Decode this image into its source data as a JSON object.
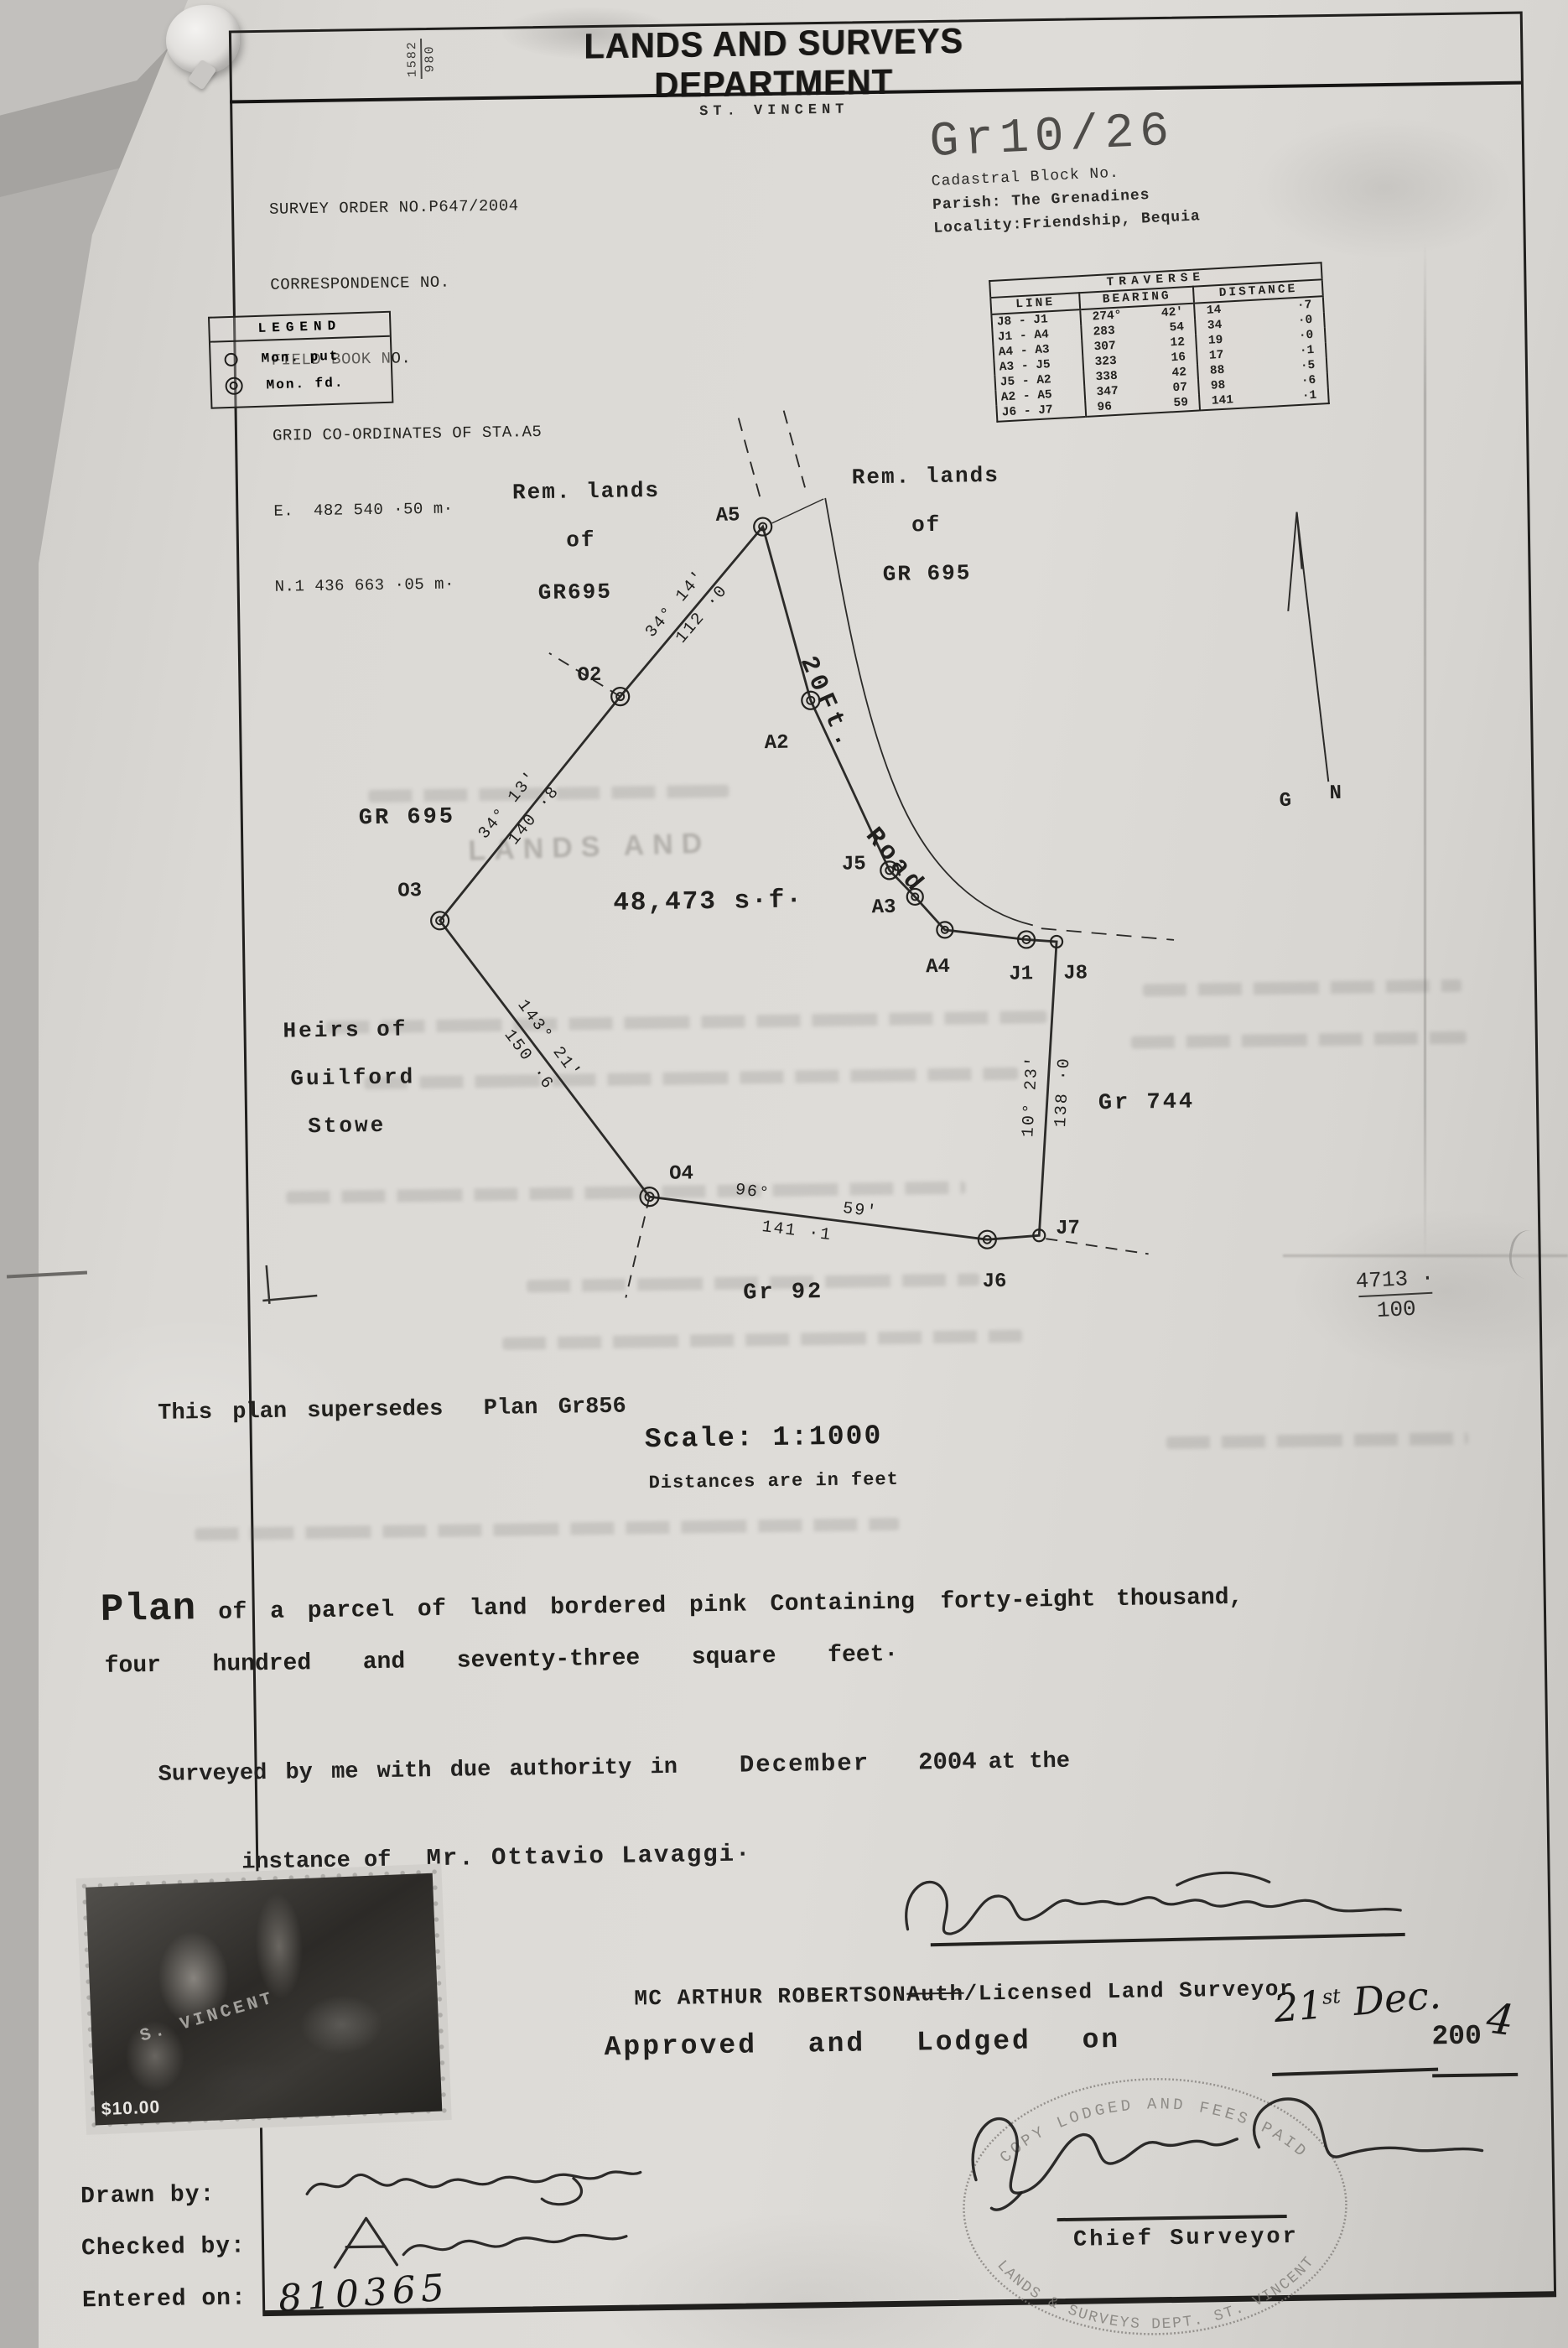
{
  "header": {
    "ref_top": "1582",
    "ref_bottom": "980",
    "title": "LANDS AND SURVEYS DEPARTMENT",
    "subtitle": "ST. VINCENT"
  },
  "survey_info": {
    "lines": [
      "SURVEY ORDER NO.P647/2004",
      "CORRESPONDENCE NO.",
      "FIELD BOOK NO.",
      "GRID CO-ORDINATES OF STA.A5",
      "E.  482 540 ·50 m·",
      "N.1 436 663 ·05 m·"
    ]
  },
  "block_ref": {
    "number": "Gr10/26",
    "label": "Cadastral Block No.",
    "parish": "Parish: The Grenadines",
    "locality": "Locality:Friendship, Bequia"
  },
  "traverse": {
    "title": "TRAVERSE",
    "col_line": "LINE",
    "col_bearing": "BEARING",
    "col_distance": "DISTANCE",
    "rows": [
      {
        "line": "J8 - J1",
        "deg": "274°",
        "min": "42'",
        "dw": "14",
        "dd": "·7"
      },
      {
        "line": "J1  - A4",
        "deg": "283",
        "min": "54",
        "dw": "34",
        "dd": "·0"
      },
      {
        "line": "A4  - A3",
        "deg": "307",
        "min": "12",
        "dw": "19",
        "dd": "·0"
      },
      {
        "line": "A3  - J5",
        "deg": "323",
        "min": "16",
        "dw": "17",
        "dd": "·1"
      },
      {
        "line": "J5  - A2",
        "deg": "338",
        "min": "42",
        "dw": "88",
        "dd": "·5"
      },
      {
        "line": "A2  - A5",
        "deg": "347",
        "min": "07",
        "dw": "98",
        "dd": "·6"
      },
      {
        "line": "J6 - J7",
        "deg": "96",
        "min": "59",
        "dw": "141",
        "dd": "·1"
      }
    ]
  },
  "legend": {
    "title": "LEGEND",
    "put_label": "Mon. put",
    "found_label": "Mon. fd."
  },
  "plot": {
    "points": {
      "a5": "A5",
      "o2": "O2",
      "a2": "A2",
      "o3": "O3",
      "j5": "J5",
      "a3": "A3",
      "a4": "A4",
      "j1": "J1",
      "j8": "J8",
      "o4": "O4",
      "j6": "J6",
      "j7": "J7"
    },
    "area": "48,473 s·f·",
    "gr695_left": "GR 695",
    "gr744": "Gr 744",
    "gr92": "Gr 92",
    "rem_left": [
      "Rem. lands",
      "of",
      "GR695"
    ],
    "rem_right": [
      "Rem. lands",
      "of",
      "GR 695"
    ],
    "heirs": [
      "Heirs of",
      "Guilford",
      "Stowe"
    ],
    "road": [
      "20Ft.",
      "Road"
    ],
    "b1": {
      "ang": "34° 14'",
      "dist": "112 ·0"
    },
    "b2": {
      "ang": "34° 13'",
      "dist": "140 ·8"
    },
    "b3": {
      "ang": "143° 21'",
      "dist": "150 ·6"
    },
    "b4": {
      "ang": "96°",
      "ang2": "59'",
      "dist": "141 ·1"
    },
    "b5": {
      "ang": "10° 23'",
      "dist": "138 ·0"
    },
    "north_g": "G",
    "north_n": "N",
    "ghost": "LANDS AND"
  },
  "notes": {
    "supersedes": "This plan supersedes  Plan Gr856",
    "scale": "Scale: 1:1000",
    "distances": "Distances are in feet",
    "frac_top": "4713 ·",
    "frac_bottom": "100"
  },
  "description": {
    "lead": "Plan",
    "body": "of a parcel of land bordered pink Containing",
    "amount1": "forty-eight thousand,",
    "amount2": "four  hundred  and  seventy-three  square  feet·"
  },
  "attestation": {
    "pre": "Surveyed by me with due authority in",
    "month": "December",
    "year": "2004",
    "post": "at the",
    "line2_pre": "instance of",
    "client": "Mr. Ottavio Lavaggi·"
  },
  "surveyor": {
    "name": "MC ARTHUR ROBERTSON",
    "struck": "Auth",
    "suffix": "/Licensed Land Surveyor"
  },
  "approval": {
    "label": "Approved and Lodged on",
    "date_num": "21",
    "date_sup": "st",
    "date_month": " Dec.",
    "year_typed": "200",
    "year_hand": "4"
  },
  "officials": {
    "chief": "Chief Surveyor",
    "drawn": "Drawn by:",
    "checked": "Checked by:",
    "entered": "Entered on:",
    "entered_value": "810365"
  },
  "stamps": {
    "oval_top": "COPY LODGED AND FEES PAID",
    "oval_bottom": "LANDS & SURVEYS DEPT. ST. VINCENT",
    "postage_value": "$10.00",
    "postage_overlay": "S. VINCENT"
  }
}
